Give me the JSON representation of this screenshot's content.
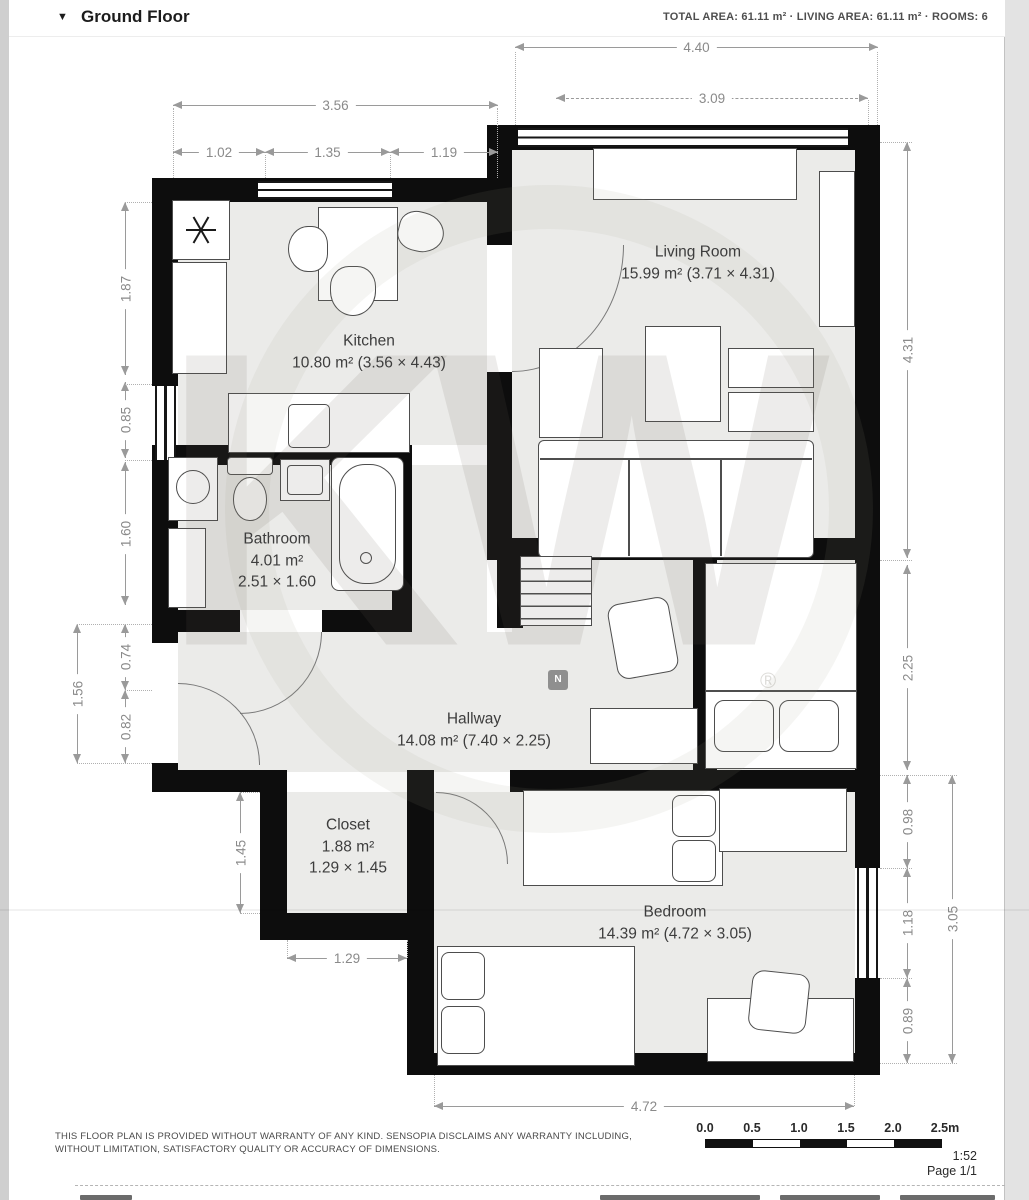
{
  "header": {
    "collapse_icon": "▼",
    "title": "Ground Floor",
    "stats": "TOTAL AREA: 61.11 m² · LIVING AREA: 61.11 m² · ROOMS: 6"
  },
  "rooms": [
    {
      "name": "Kitchen",
      "area": "10.80 m² (3.56 × 4.43)"
    },
    {
      "name": "Living Room",
      "area": "15.99 m² (3.71 × 4.31)"
    },
    {
      "name": "Bathroom",
      "area": "4.01 m²",
      "dims": "2.51 × 1.60"
    },
    {
      "name": "Hallway",
      "area": "14.08 m² (7.40 × 2.25)"
    },
    {
      "name": "Closet",
      "area": "1.88 m²",
      "dims": "1.29 × 1.45"
    },
    {
      "name": "Bedroom",
      "area": "14.39 m² (4.72 × 3.05)"
    }
  ],
  "dims": {
    "top_outer": "4.40",
    "top_inner": "3.09",
    "kitchen_width": "3.56",
    "k1": "1.02",
    "k2": "1.35",
    "k3": "1.19",
    "l1": "1.87",
    "l2": "0.85",
    "l3": "1.60",
    "l4": "0.74",
    "l5": "0.82",
    "l_outer": "1.56",
    "closet_h": "1.45",
    "r1": "4.31",
    "r2": "2.25",
    "r3": "0.98",
    "r4": "1.18",
    "r5": "0.89",
    "r_outer": "3.05",
    "closet_w": "1.29",
    "bedroom_w": "4.72"
  },
  "watermark": {
    "letters": "KW",
    "reg": "®",
    "compass": "N"
  },
  "footer": {
    "disclaimer1": "THIS FLOOR PLAN IS PROVIDED WITHOUT WARRANTY OF ANY KIND. SENSOPIA DISCLAIMS ANY WARRANTY INCLUDING,",
    "disclaimer2": "WITHOUT LIMITATION, SATISFACTORY QUALITY OR ACCURACY OF DIMENSIONS.",
    "scale_labels": [
      "0.0",
      "0.5",
      "1.0",
      "1.5",
      "2.0",
      "2.5m"
    ],
    "scale_ratio": "1:52",
    "page": "Page 1/1"
  }
}
